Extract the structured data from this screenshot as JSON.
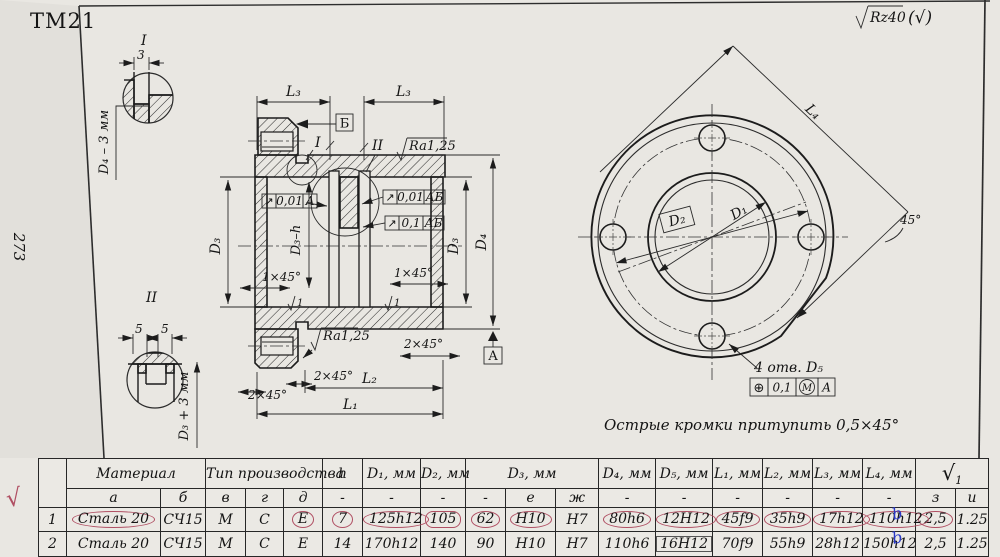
{
  "page": {
    "title": "ТМ21",
    "page_number": "273",
    "check_mark": "√"
  },
  "general_roughness": {
    "value": "Rz40",
    "alt": "(√)"
  },
  "detail_i": {
    "label": "I",
    "dim": "3",
    "note": "D₄ – 3 мм"
  },
  "detail_ii": {
    "label": "II",
    "dim_left": "5",
    "dim_right": "5",
    "note": "D₃ + 3 мм"
  },
  "section": {
    "l3_left": "L₃",
    "l3_right": "L₃",
    "datum_b": "Б",
    "ref_i": "I",
    "ref_ii": "II",
    "ra_top": "Ra1,25",
    "ra_bottom": "Ra1,25",
    "frame1_sym": "↗",
    "frame1_val": "0,01",
    "frame1_datum": "А",
    "frame2_sym": "↗",
    "frame2_val": "0,01",
    "frame2_datum": "АБ",
    "frame3_sym": "↗",
    "frame3_val": "0,1",
    "frame3_datum": "АБ",
    "chamfer_left": "1×45°",
    "chamfer_right": "1×45°",
    "chamfer2_right": "2×45°",
    "chamfer2_mid": "2×45°",
    "chamfer2_left": "2×45°",
    "d3h": "D₃–h",
    "d3_left": "D₃",
    "d3_right": "D₃",
    "d4": "D₄",
    "l2": "L₂",
    "l1": "L₁",
    "datum_a": "А",
    "r1_left": "1",
    "r1_right": "1"
  },
  "front": {
    "l4": "L₄",
    "angle": "45°",
    "d1": "D₁",
    "d2": "D₂",
    "holes_note": "4 отв. D₅",
    "pos_sym": "⊕",
    "pos_val": "0,1",
    "pos_mod": "М",
    "pos_datum": "А",
    "edge_note": "Острые кромки притупить 0,5×45°"
  },
  "table": {
    "headers": {
      "material": "Материал",
      "production": "Тип производства",
      "h": "h",
      "d1": "D₁, мм",
      "d2": "D₂, мм",
      "d3": "D₃, мм",
      "d4": "D₄, мм",
      "d5": "D₅, мм",
      "l1": "L₁, мм",
      "l2": "L₂, мм",
      "l3": "L₃, мм",
      "l4": "L₄, мм",
      "rough_sym": "√",
      "rough_idx": "1"
    },
    "subheaders": [
      "а",
      "б",
      "в",
      "г",
      "д",
      "-",
      "-",
      "-",
      "-",
      "е",
      "ж",
      "-",
      "-",
      "-",
      "-",
      "-",
      "-",
      "з",
      "и"
    ],
    "rows": [
      {
        "num": "1",
        "cells": [
          "Сталь 20",
          "СЧ15",
          "М",
          "С",
          "Е",
          "7",
          "125h12",
          "105",
          "62",
          "Н10",
          "Н7",
          "80h6",
          "12Н12",
          "45f9",
          "35h9",
          "17h12",
          "110h12",
          "2,5",
          "1.25"
        ]
      },
      {
        "num": "2",
        "cells": [
          "Сталь 20",
          "СЧ15",
          "М",
          "С",
          "Е",
          "14",
          "170h12",
          "140",
          "90",
          "Н10",
          "Н7",
          "110h6",
          "16Н12",
          "70f9",
          "55h9",
          "28h12",
          "150h12",
          "2,5",
          "1.25"
        ]
      }
    ]
  },
  "annotations": {
    "blue_mark": "b"
  }
}
